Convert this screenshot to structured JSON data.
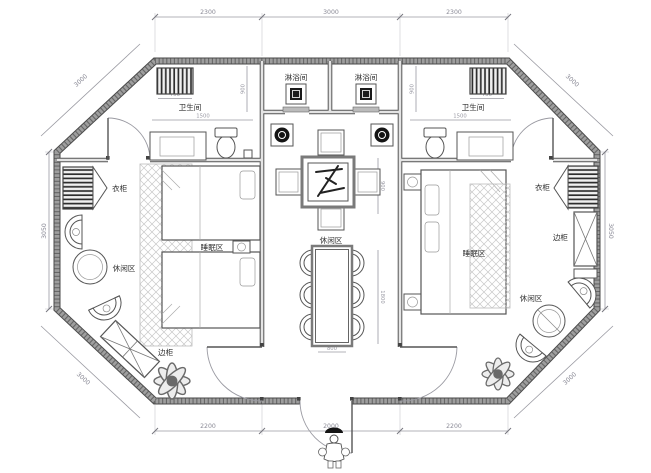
{
  "labels": {
    "bathroom_left": "卫生间",
    "bathroom_right": "卫生间",
    "shower_left": "淋浴间",
    "shower_right": "淋浴间",
    "wardrobe_left": "衣柜",
    "wardrobe_right": "衣柜",
    "leisure_left": "休闲区",
    "leisure_center": "休闲区",
    "leisure_right": "休闲区",
    "sleep_left": "睡眠区",
    "sleep_right": "睡眠区",
    "cabinet_left": "边柜",
    "cabinet_right": "边柜"
  },
  "dimensions": {
    "top": [
      "2300",
      "3000",
      "2300"
    ],
    "bottom": [
      "2200",
      "2000",
      "2200"
    ],
    "left": "3050",
    "right": "3050",
    "diag_top_left": "3000",
    "diag_top_right": "3000",
    "diag_bottom_left": "3000",
    "diag_bottom_right": "3000",
    "inner": {
      "rad_left": "750",
      "rad_right": "750",
      "bath_left_width": "1500",
      "bath_right_width": "1500",
      "bath_left_height": "900",
      "bath_right_height": "900",
      "table_side": "900",
      "dining_length": "1800",
      "dining_width": "800"
    }
  },
  "colors": {
    "background": "#ffffff",
    "wall_fill": "#9e9e9e",
    "wall_edge": "#4a4a4a",
    "wall_hatch": "#3a3a3a",
    "partition": "#555555",
    "fixture_line": "#555555",
    "dim_line": "#9a9aa2",
    "dim_text": "#8a8a96",
    "carpet_hatch": "#c8c8c8"
  }
}
